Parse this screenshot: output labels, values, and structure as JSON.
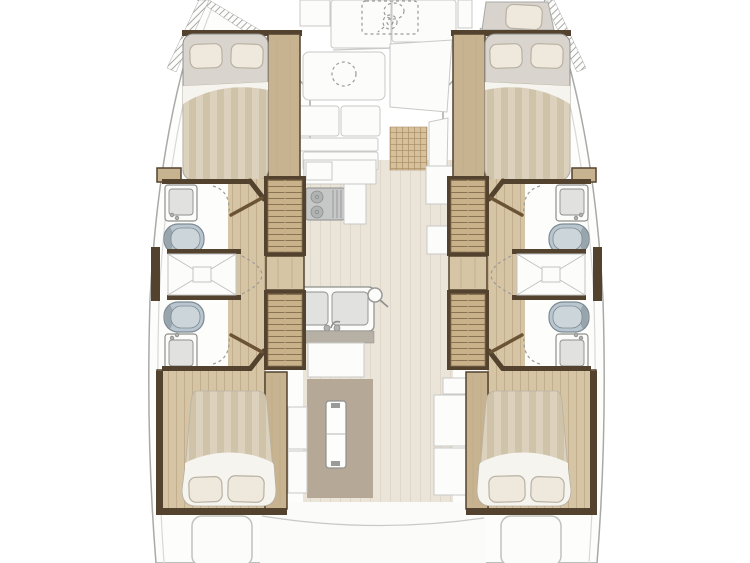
{
  "diagram": {
    "label": "Catamaran interior floor plan, top-down view",
    "type": "boat-deck-plan",
    "view": "top-down",
    "port_hull_label": "Port hull: forward double cabin, forward bathroom, central shower, aft bathroom, aft double cabin",
    "starboard_hull_label": "Starboard hull: forepeak berth, forward double cabin, forward bathroom, central shower, aft bathroom, aft double cabin",
    "bridgedeck_label": "Bridgedeck: foredeck lockers with anchor windlass, forward seating and table, galley with cooktop and double sink, dinette table, aft cockpit",
    "fixtures": [
      "anchor-windlass",
      "foredeck-locker",
      "forward-table",
      "sofa-cushions",
      "woven-deck-mat",
      "stove-cooktop",
      "galley-counter",
      "double-sink",
      "galley-cabinet",
      "companionway-stairs",
      "hand-basin",
      "toilet",
      "shower-tray",
      "double-bed",
      "pillow",
      "wardrobe-panel",
      "dinette-table",
      "bench-seat",
      "stern-steps",
      "forepeak-berth"
    ]
  },
  "colors": {
    "deck_white": "#fdfdfc",
    "panel_white": "#fcfcfa",
    "panel_edge": "#c9c9c7",
    "outline_strong": "#a9a9a7",
    "outline_soft": "#d8d8d6",
    "wall": "#53422e",
    "wood_panel": "#c8b391",
    "stair_tread": "#c9b28a",
    "stair_line": "#8a7254",
    "corridor": "#d6c5a5",
    "corridor_line": "#c2ae8c",
    "salon_floor": "#eae4d9",
    "salon_floor_line": "#ded7ca",
    "mattress": "#d9d5ce",
    "duvet_light": "#dcd1bc",
    "duvet_dark": "#cfc3aa",
    "sheet_white": "#f6f4ef",
    "pillow": "#efe9dd",
    "pillow_edge": "#b8b1a2",
    "toilet_body": "#b9c6cf",
    "toilet_seat": "#ccd5da",
    "toilet_edge": "#7d8a92",
    "fixture_edge": "#8e8e8c",
    "basin": "#e1e2e0",
    "steel": "#c6c8c7",
    "burner": "#afb3b2",
    "counter_gray": "#b7b1a5",
    "mat": "#b5a897",
    "grid_base": "#d7c09c",
    "grid_line": "#ab8f66",
    "hatch_line": "#a8a8a6",
    "dash": "#9a9a98",
    "door": "#6b5335",
    "shower_line": "#c3c3c1"
  }
}
